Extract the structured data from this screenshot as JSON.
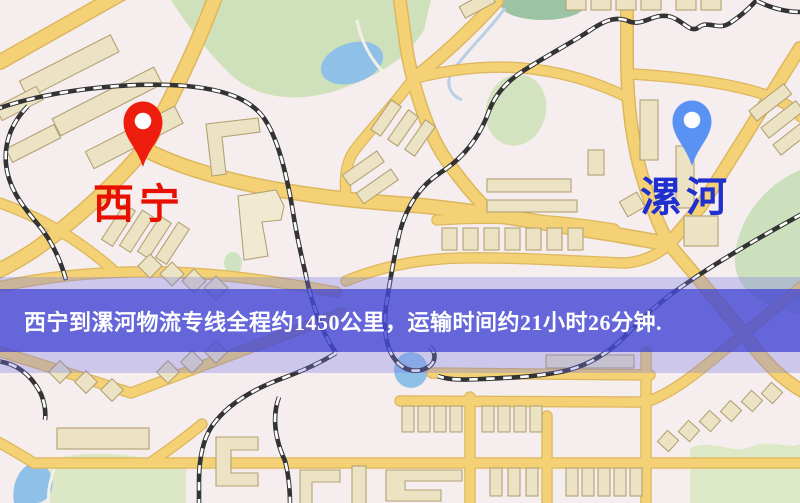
{
  "map": {
    "origin_marker": {
      "label": "西宁",
      "pin_color": "#ee1d0d",
      "label_color": "#e80f00"
    },
    "destination_marker": {
      "label": "漯河",
      "pin_color": "#5a92f4",
      "label_color": "#2030cf"
    },
    "banner": {
      "text": "西宁到漯河物流专线全程约1450公里，运输时间约21小时26分钟.",
      "text_color": "#ffffff",
      "band_color": "rgba(64,68,212,0.74)",
      "halo_color": "rgba(118,120,230,0.32)"
    },
    "route": {
      "origin": "西宁",
      "destination": "漯河",
      "distance_text": "约1450公里",
      "duration_text": "约21小时26分钟"
    }
  }
}
